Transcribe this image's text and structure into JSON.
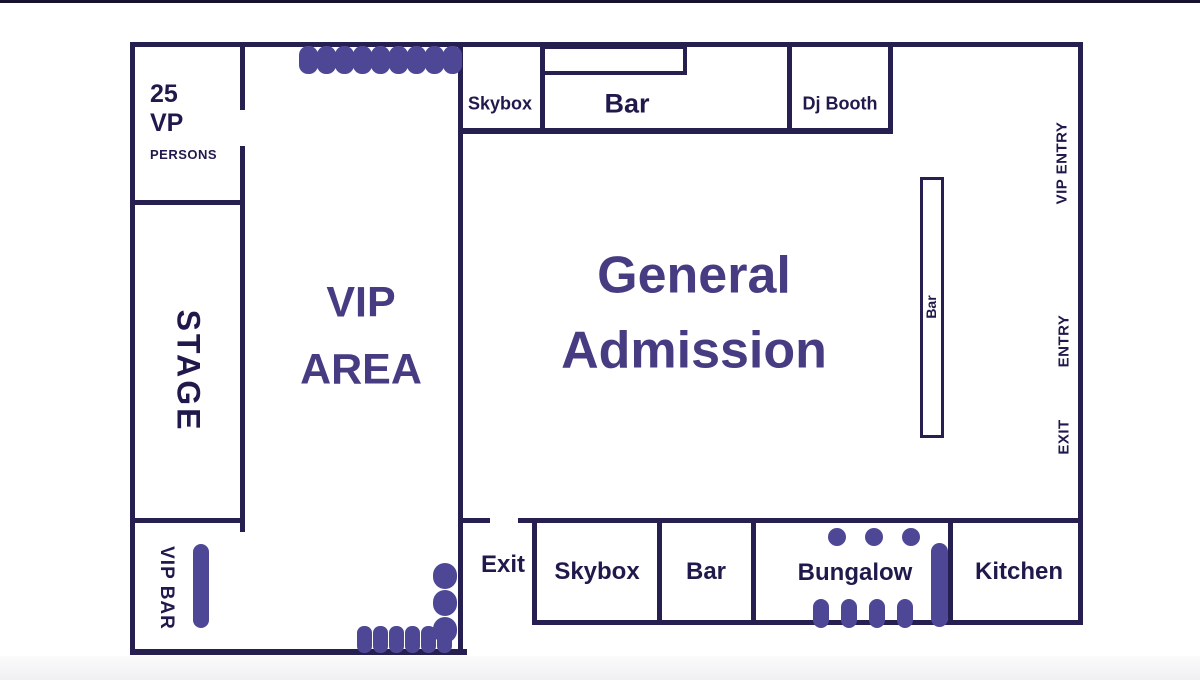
{
  "title": "Venue floor plan",
  "palette": {
    "wall": "#262051",
    "label_text": "#1f1a4b",
    "accent_text": "#473c82",
    "furniture": "#4e4796",
    "background": "#ffffff",
    "top_edge": "#17132f"
  },
  "rooms": {
    "vp_room": {
      "capacity": "25",
      "line2": "VP",
      "line3": "PERSONS"
    },
    "stage": "STAGE",
    "vip_bar": "VIP BAR",
    "vip_area": {
      "line1": "VIP",
      "line2": "AREA"
    },
    "general_admission": {
      "line1": "General",
      "line2": "Admission"
    },
    "skybox_top": "Skybox",
    "bar_top": "Bar",
    "dj_booth": "Dj Booth",
    "ga_bar": "Bar",
    "exit_corridor": "Exit",
    "skybox_bottom": "Skybox",
    "bar_bottom": "Bar",
    "bungalow": "Bungalow",
    "kitchen": "Kitchen"
  },
  "wall_labels": {
    "vip_entry": "VIP ENTRY",
    "entry": "ENTRY",
    "exit": "EXIT"
  },
  "furniture": {
    "vip_top_seats": 9,
    "vip_side_seats": 3,
    "vip_bottom_seats": 6,
    "bungalow_top_seats": 3,
    "bungalow_bottom_seats": 4
  }
}
